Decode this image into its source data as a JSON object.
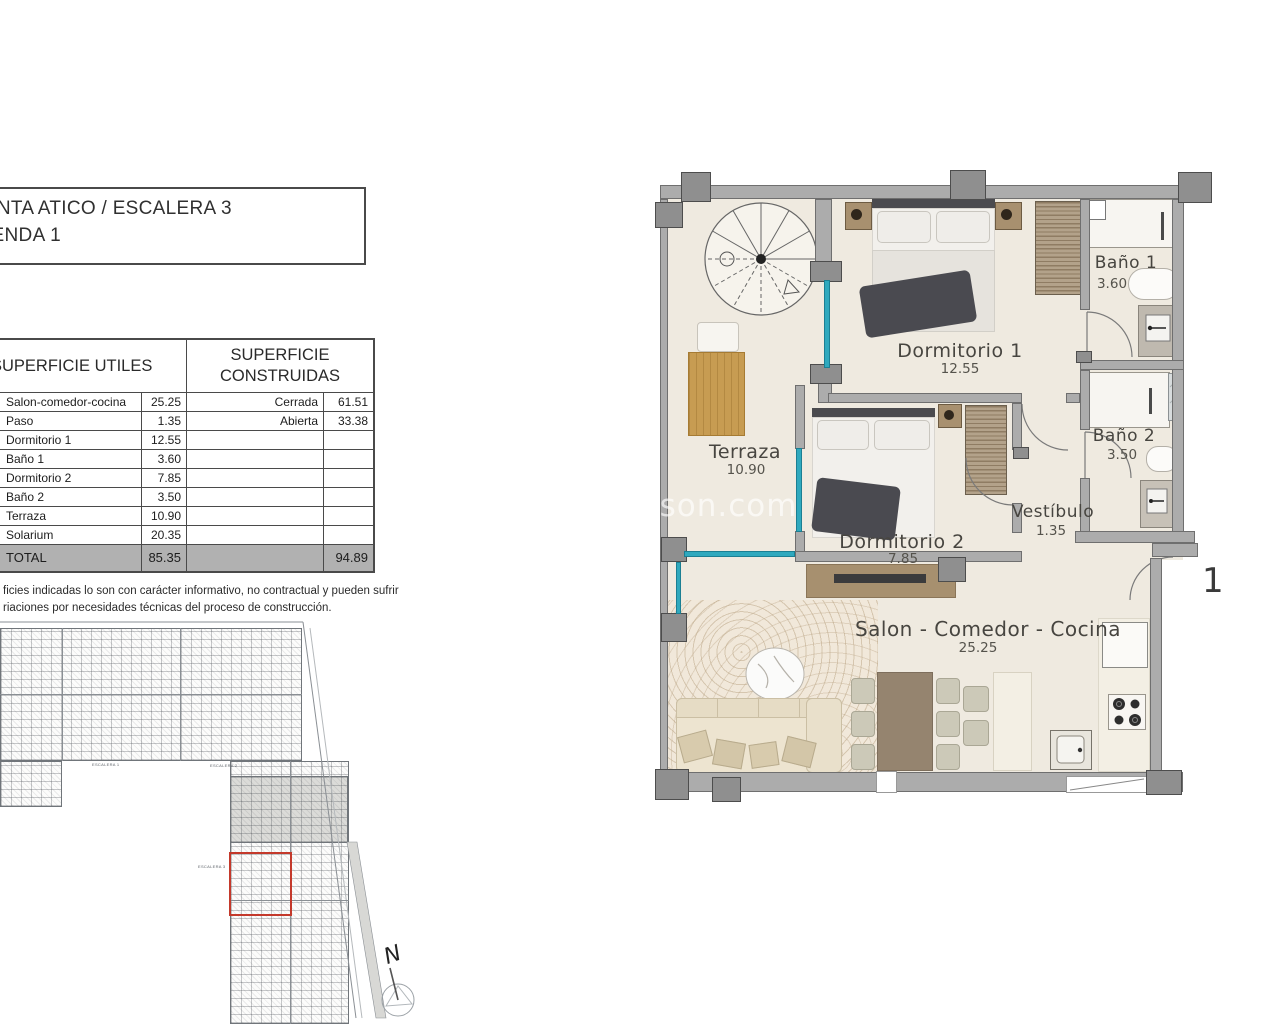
{
  "title_box": {
    "line1": "LANTA ATICO / ESCALERA 3",
    "line2": "VIENDA 1"
  },
  "areas_table": {
    "left_header": "SUPERFICIE UTILES",
    "right_header_line1": "SUPERFICIE",
    "right_header_line2": "CONSTRUIDAS",
    "utiles_rows": [
      {
        "name": "Salon-comedor-cocina",
        "value": "25.25"
      },
      {
        "name": "Paso",
        "value": "1.35"
      },
      {
        "name": "Dormitorio 1",
        "value": "12.55"
      },
      {
        "name": "Baño 1",
        "value": "3.60"
      },
      {
        "name": "Dormitorio 2",
        "value": "7.85"
      },
      {
        "name": "Baño 2",
        "value": "3.50"
      },
      {
        "name": "Terraza",
        "value": "10.90"
      },
      {
        "name": "Solarium",
        "value": "20.35"
      }
    ],
    "construidas_rows": [
      {
        "name": "Cerrada",
        "value": "61.51"
      },
      {
        "name": "Abierta",
        "value": "33.38"
      }
    ],
    "total": {
      "label": "TOTAL",
      "utiles": "85.35",
      "construidas": "94.89"
    }
  },
  "disclaimer": {
    "line1": "ficies indicadas lo son con carácter informativo, no contractual y pueden sufrir",
    "line2": "riaciones por necesidades técnicas del proceso de construcción."
  },
  "floorplan": {
    "rooms": [
      {
        "label": "Terraza",
        "area": "10.90"
      },
      {
        "label": "Dormitorio 1",
        "area": "12.55"
      },
      {
        "label": "Baño 1",
        "area": "3.60"
      },
      {
        "label": "Baño 2",
        "area": "3.50"
      },
      {
        "label": "Dormitorio 2",
        "area": "7.85"
      },
      {
        "label": "Vestíbulo",
        "area": "1.35"
      },
      {
        "label": "Salon - Comedor - Cocina",
        "area": "25.25"
      }
    ],
    "stair_number": "1"
  },
  "siteplan": {
    "escalera_labels": [
      "ESCALERA 1",
      "ESCALERA 2",
      "ESCALERA 3"
    ],
    "compass_letter": "N",
    "highlight_color": "#c4392b"
  },
  "watermark": "lson.com",
  "colors": {
    "floor_beige": "#efeae0",
    "wall_gray": "#acacac",
    "window_cyan": "#2fa9be",
    "total_row_gray": "#b1b1b1"
  }
}
